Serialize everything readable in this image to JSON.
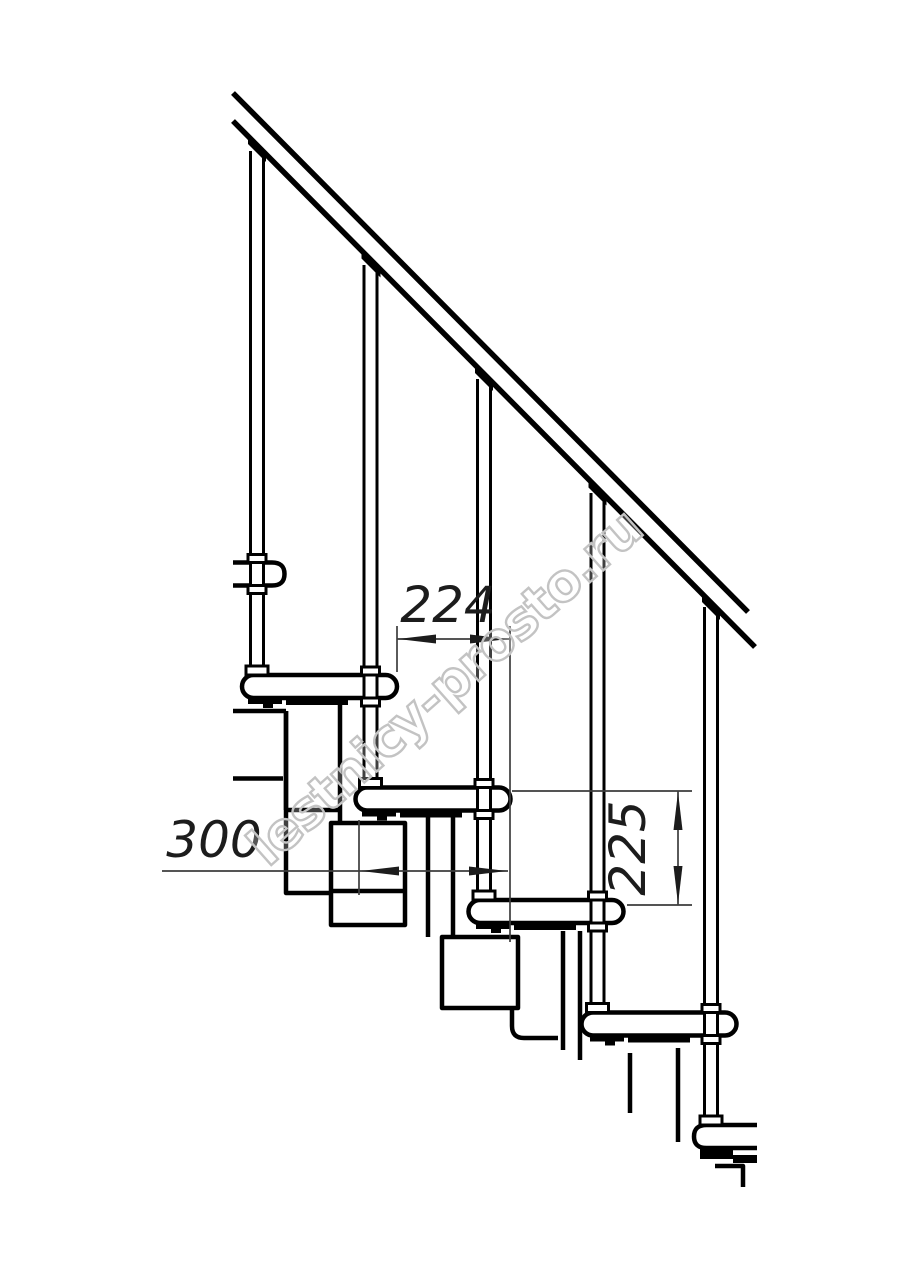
{
  "drawing": {
    "background_color": "#ffffff",
    "line_color": "#000000",
    "dimension_color": "#1c1c1c",
    "watermark_color": "#c3c3c3",
    "tread_count_visible": 6,
    "baluster_count": 5
  },
  "dimensions": [
    {
      "id": "tread-pitch",
      "value": "224",
      "orientation": "horizontal"
    },
    {
      "id": "module-length",
      "value": "300",
      "orientation": "horizontal"
    },
    {
      "id": "step-height",
      "value": "225",
      "orientation": "vertical"
    }
  ],
  "watermark": {
    "text": "lestnicy-prosto.ru"
  }
}
